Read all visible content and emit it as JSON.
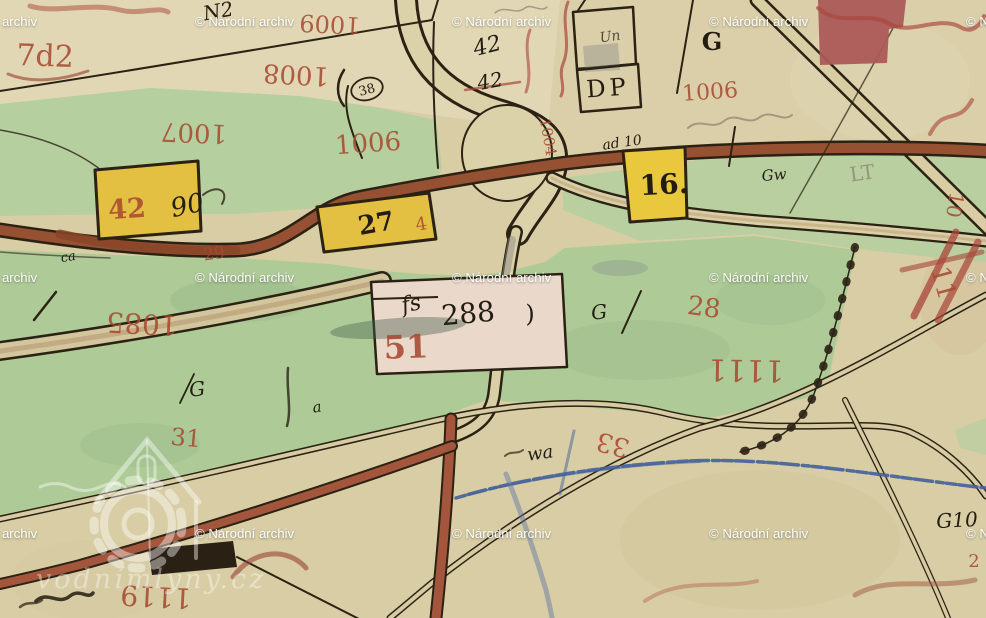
{
  "title": "Historical cadastral map scan",
  "colors": {
    "paper": "#d8cda4",
    "paper_light": "#e7ddc0",
    "meadow_green": "#b6cf9f",
    "road_sienna": "#9b5433",
    "road_fill": "#d9cfa6",
    "ink_black": "#2b2214",
    "label_red": "#a84a32",
    "stream_blue": "#44619c",
    "building_yellow": "#e3c041",
    "building_pink": "#ead8ca",
    "building_red": "#ac5a57",
    "watermark_white": "#ffffff"
  },
  "watermark": {
    "label": "© Národní archiv",
    "logo_text": "vodnímlyny.cz"
  },
  "labels": {
    "red": {
      "r7d2": "7d2",
      "r1009": "1009",
      "r1008": "1008",
      "r1007": "1007",
      "r1006a": "1006",
      "r1006b": "1006",
      "r1004": "1004",
      "r42": "42",
      "r4": "4",
      "r29": "29",
      "r1085": "1085",
      "r51": "51",
      "r28": "28",
      "r1111": "1111",
      "r31": "31",
      "r33": "33",
      "r1119": "1119",
      "r10": "10",
      "r11": "11",
      "r2": "2"
    },
    "black": {
      "n2": "N2",
      "k42a": "42",
      "k42b": "42",
      "k38": "38",
      "k90": "90",
      "k27": "27",
      "k16": "16.",
      "kdp": "DP",
      "kun": "Un",
      "kad10": "ad 10",
      "kgtop": "G",
      "kgw": "Gw",
      "klt": "LT",
      "kca": "ca",
      "kfs": "fs",
      "k288": "288",
      "kparen": ")",
      "kgmid": "G",
      "kgleft": "G",
      "ka": "a",
      "kwa": "wa",
      "kg10": "G10"
    }
  }
}
